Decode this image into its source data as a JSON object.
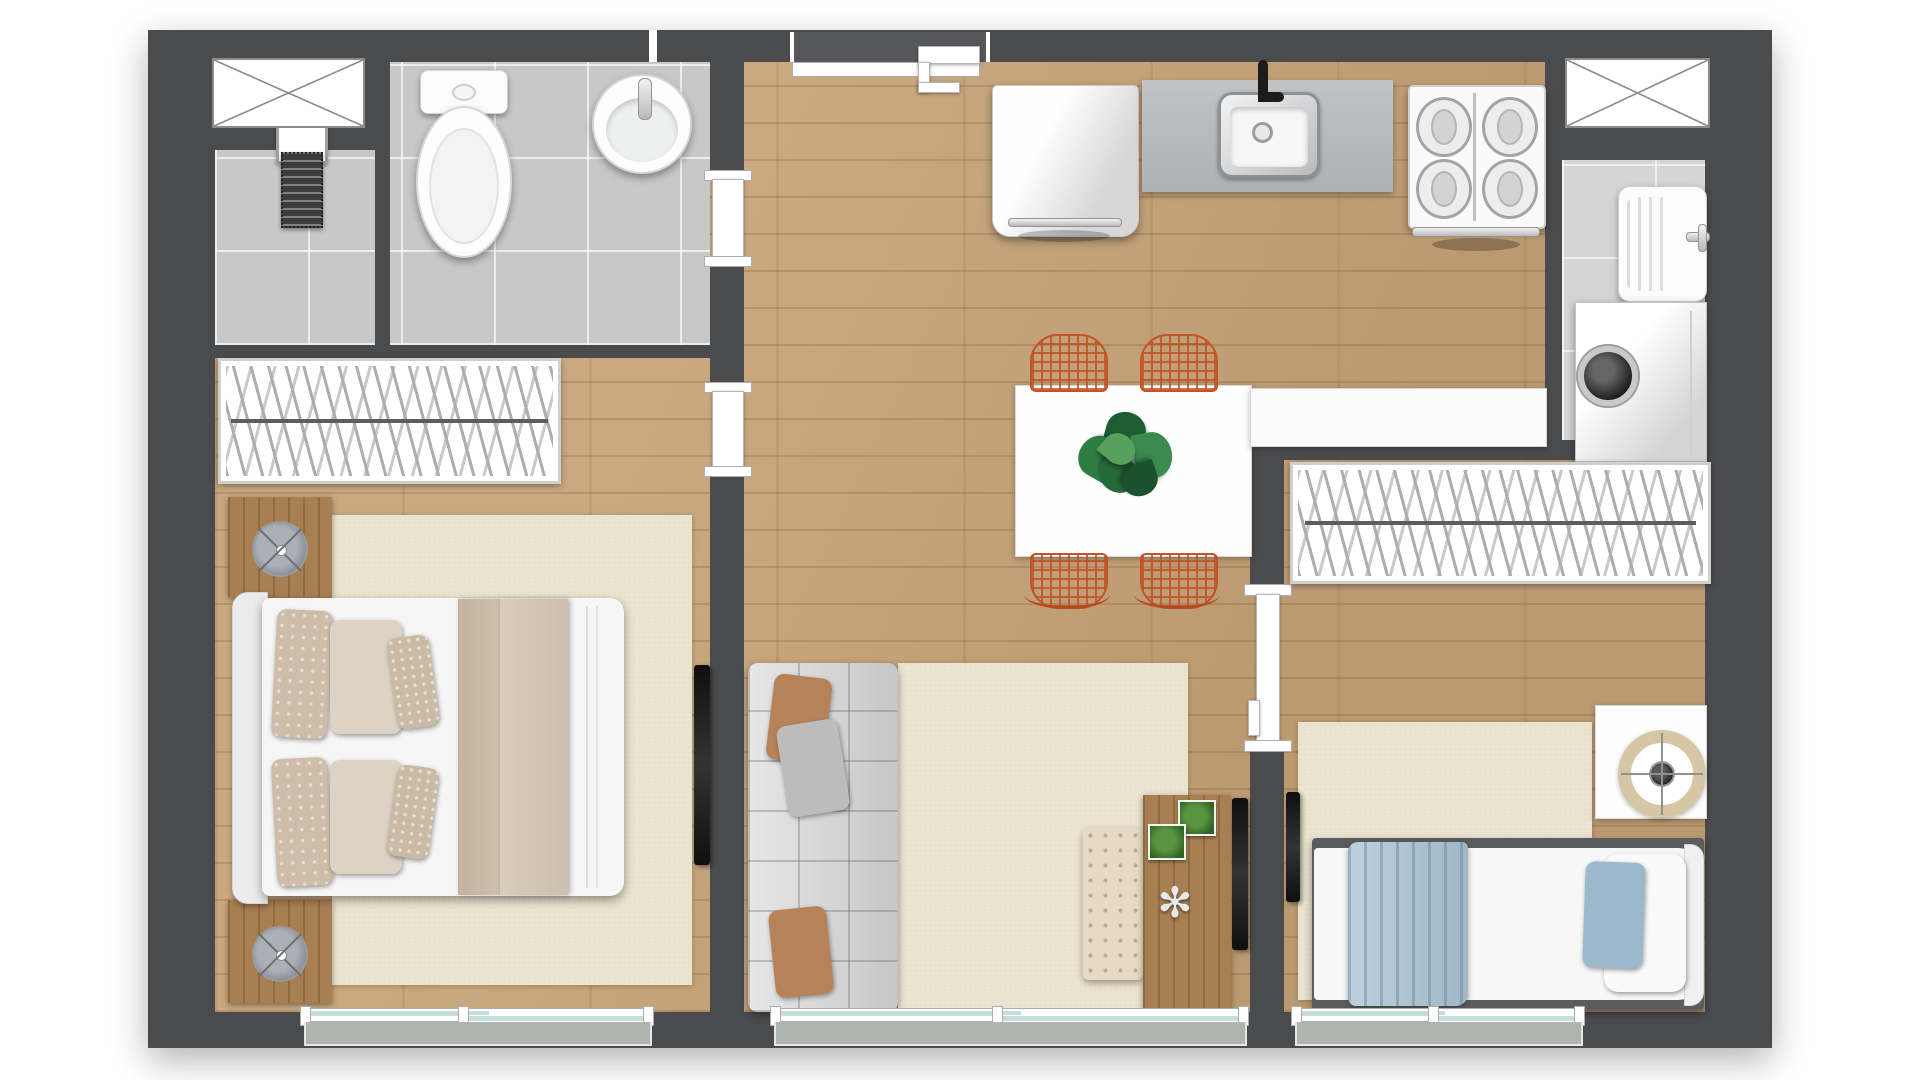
{
  "meta": {
    "title": "Apartment floor plan — rendered top view",
    "render_style": "architectural 3D top-down"
  },
  "palette": {
    "wall": "#4a4b4d",
    "wood_floor": "#c6a277",
    "bathroom_tile": "#c8c8c8",
    "laundry_tile": "#d5d5d5",
    "rug_cream": "#ebe4d0",
    "chair_orange": "#c35227",
    "blanket_blue": "#a7c1d2",
    "balcony_slab": "#adb5ae",
    "window_glass": "#c5dedb"
  },
  "rooms": {
    "shower_room": "Shower enclosure",
    "bathroom": "Bathroom",
    "entrance_hall": "Entrance hall",
    "kitchen": "Kitchen",
    "living_dining": "Living / dining room",
    "bedroom_1": "Bedroom 1 (double)",
    "laundry": "Laundry area",
    "bedroom_2": "Bedroom 2 (single)"
  },
  "furniture": {
    "bathroom": [
      "toilet",
      "round washbasin",
      "linear shower drain"
    ],
    "kitchen": [
      "refrigerator",
      "countertop with inset sink",
      "four-burner stove"
    ],
    "living_dining": [
      "white dining table",
      "wire dining chair",
      "monstera plant centerpiece",
      "white peninsula counter",
      "modular tufted sofa",
      "cream area rug",
      "tufted ottoman pouf",
      "wood sideboard",
      "flat TV"
    ],
    "bedroom_1": [
      "wardrobe with hangers",
      "double bed",
      "nightstand",
      "table lamp",
      "cream area rug",
      "flat TV"
    ],
    "laundry": [
      "utility wash tank",
      "washing machine"
    ],
    "bedroom_2": [
      "wardrobe with hangers",
      "single bed with blue throw",
      "white desk",
      "round swivel chair",
      "cream area rug",
      "flat TV"
    ]
  },
  "openings": {
    "windows_top": [
      "bathroom window",
      "laundry window"
    ],
    "windows_bottom": [
      "bedroom 1 sliding window",
      "living room sliding door",
      "bedroom 2 sliding window"
    ],
    "doors": [
      "entrance door",
      "bathroom pocket door",
      "bedroom 1 pocket door",
      "bedroom 2 pocket door"
    ]
  }
}
